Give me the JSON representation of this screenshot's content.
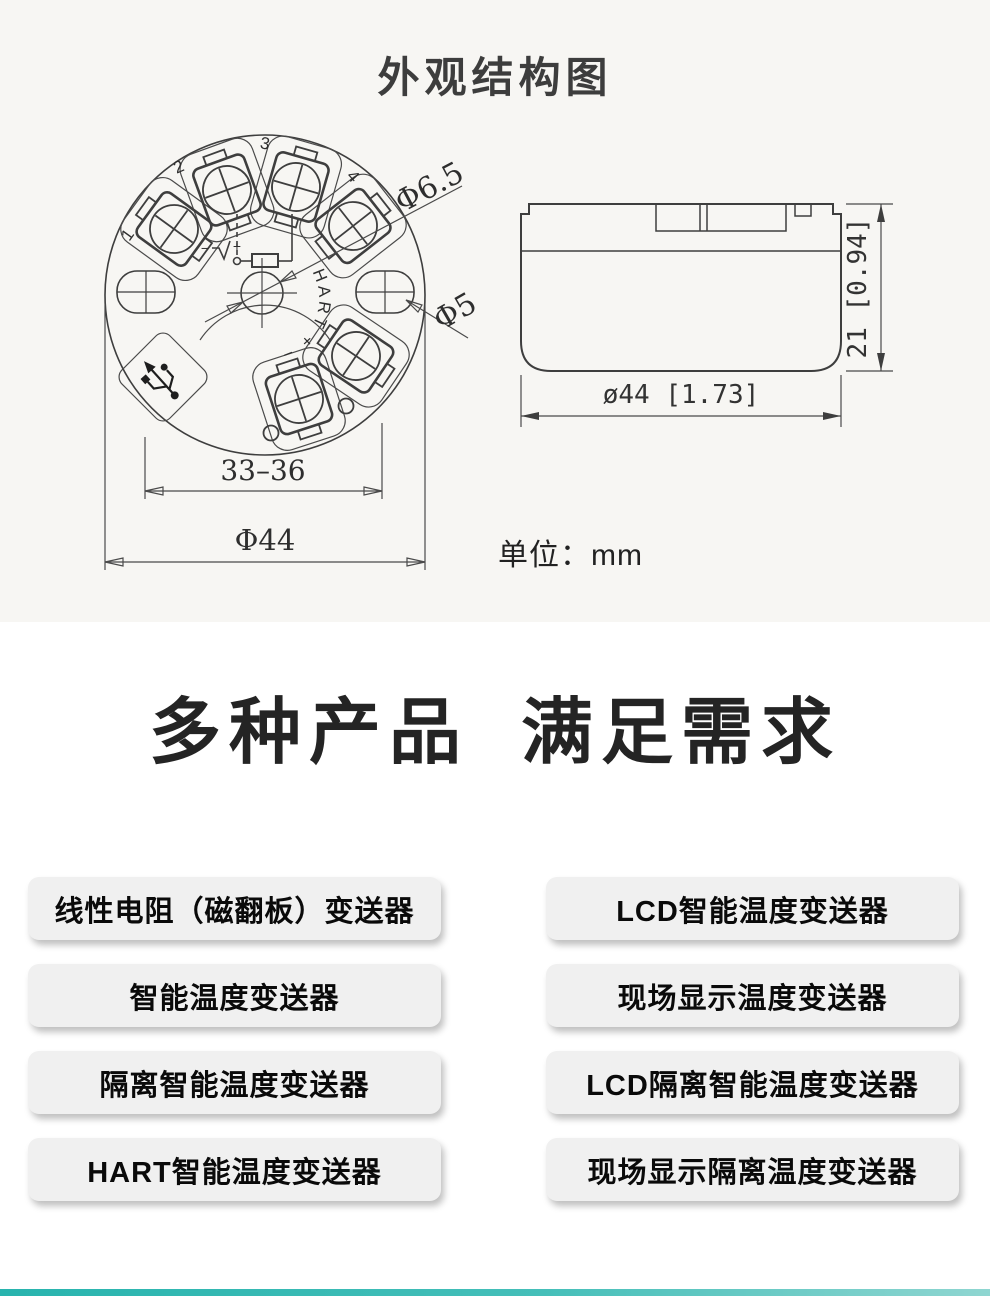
{
  "page": {
    "accent_teal": "#28b4ae",
    "top_bg": "#f7f6f3"
  },
  "structure_section": {
    "title": "外观结构图",
    "unit_label": "单位：mm",
    "front_view": {
      "terminal_1": "1",
      "terminal_2": "2",
      "terminal_3": "3",
      "terminal_4": "4",
      "center_label": "HART + −",
      "schematic_minus": "−",
      "schematic_plus": "+",
      "dim_hole_large": "Φ6.5",
      "dim_hole_small": "Φ5",
      "dim_span": "33–36",
      "dim_diameter": "Φ44"
    },
    "side_view": {
      "dim_width": "ø44 [1.73]",
      "dim_height": "21 [0.94]"
    }
  },
  "products_section": {
    "heading_left": "多种产品",
    "heading_right": "满足需求",
    "left_buttons": [
      "线性电阻（磁翻板）变送器",
      "智能温度变送器",
      "隔离智能温度变送器",
      "HART智能温度变送器"
    ],
    "right_buttons": [
      "LCD智能温度变送器",
      "现场显示温度变送器",
      "LCD隔离智能温度变送器",
      "现场显示隔离温度变送器"
    ]
  }
}
